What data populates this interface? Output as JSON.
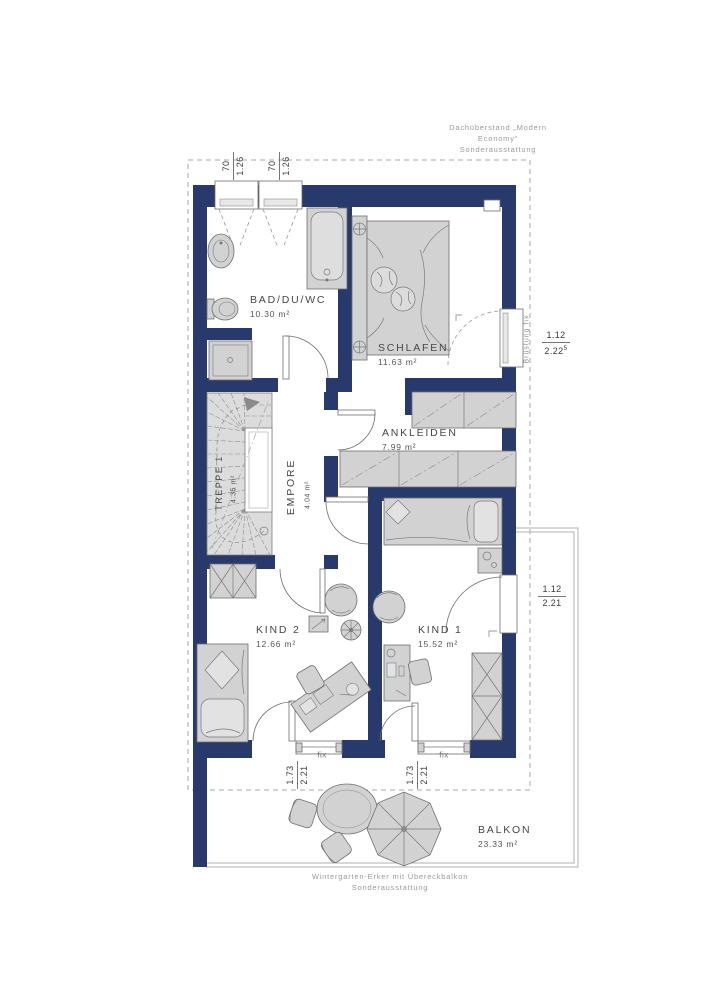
{
  "colors": {
    "wall": "#273a6b",
    "furniture": "#d2d2d2",
    "dash": "#9a9a9a"
  },
  "notes": {
    "roof_line1": "Dachüberstand „Modern",
    "roof_line2": "Economy“",
    "roof_line3": "Sonderausstattung",
    "balcony_line1": "Wintergarten-Erker mit Übereckbalkon",
    "balcony_line2": "Sonderausstattung"
  },
  "rooms": {
    "bad": {
      "name": "BAD/DU/WC",
      "area": "10.30 m²"
    },
    "schlafen": {
      "name": "SCHLAFEN",
      "area": "11.63 m²"
    },
    "ankleiden": {
      "name": "ANKLEIDEN",
      "area": "7.99 m²"
    },
    "empore": {
      "name": "EMPORE",
      "area": "4.04 m²"
    },
    "treppe": {
      "name": "TREPPE 1",
      "area": "4.35 m²"
    },
    "kind2": {
      "name": "KIND 2",
      "area": "12.66 m²"
    },
    "kind1": {
      "name": "KIND 1",
      "area": "15.52 m²"
    },
    "balkon": {
      "name": "BALKON",
      "area": "23.33 m²"
    }
  },
  "dims": {
    "roof_win1": {
      "num": "70",
      "den": "1.26"
    },
    "roof_win2": {
      "num": "70",
      "den": "1.26"
    },
    "right_upper": {
      "num": "1.12",
      "den": "2.22",
      "sup": "5"
    },
    "right_lower": {
      "num": "1.12",
      "den": "2.21"
    },
    "bottom1": {
      "num": "1.73",
      "den": "2.21"
    },
    "bottom2": {
      "num": "1.73",
      "den": "2.21"
    }
  },
  "labels": {
    "bruestung": "Brüstung fix",
    "fix1": "fix",
    "fix2": "fix"
  }
}
